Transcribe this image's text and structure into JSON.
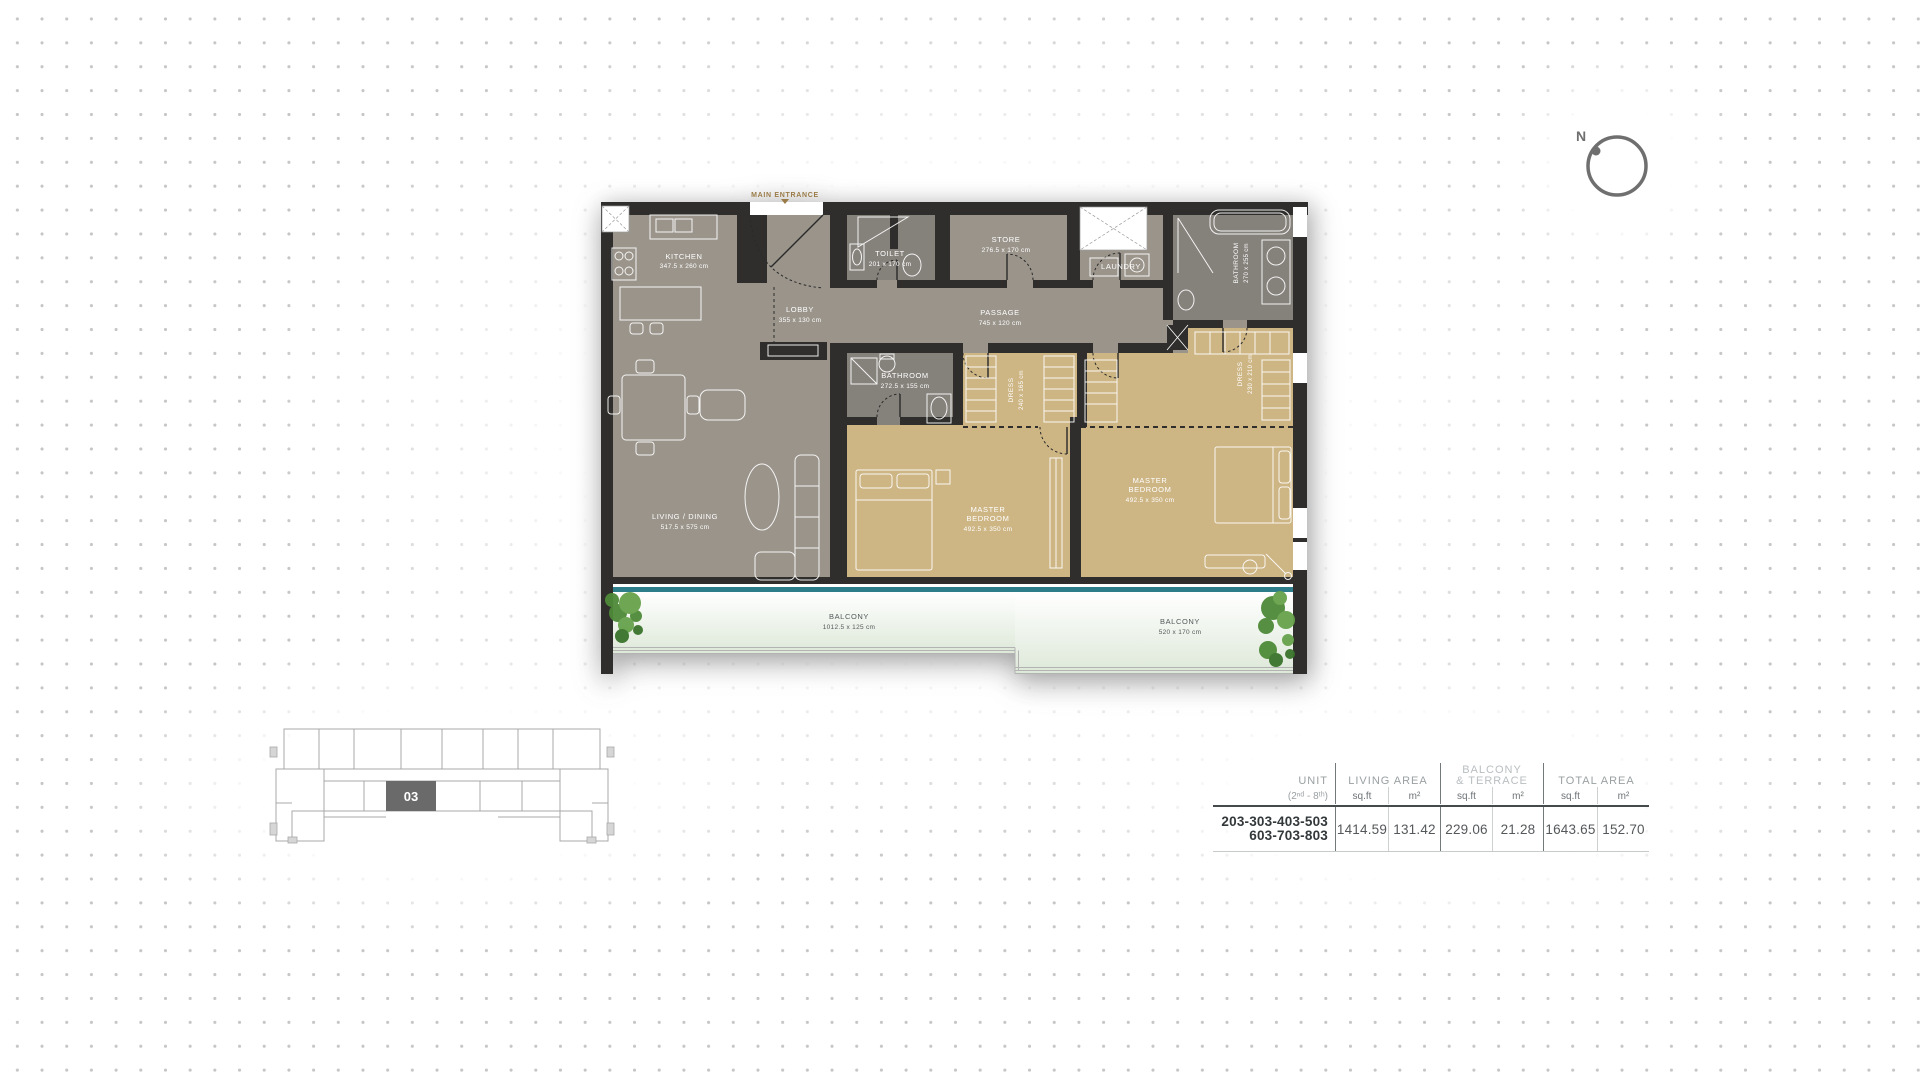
{
  "compass": {
    "label": "N"
  },
  "plan": {
    "entrance": {
      "label": "MAIN ENTRANCE"
    },
    "rooms": {
      "kitchen": {
        "name": "KITCHEN",
        "dims": "347.5 x 260 cm"
      },
      "toilet": {
        "name": "TOILET",
        "dims": "201 x 170 cm"
      },
      "store": {
        "name": "STORE",
        "dims": "276.5 x 170 cm"
      },
      "laundry": {
        "name": "LAUNDRY"
      },
      "bathroom_top_right": {
        "name": "BATHROOM",
        "dims": "270 x 255 cm"
      },
      "dress_right": {
        "name": "DRESS",
        "dims": "230 x 210 cm"
      },
      "lobby": {
        "name": "LOBBY",
        "dims": "355 x 130 cm"
      },
      "passage": {
        "name": "PASSAGE",
        "dims": "745 x 120 cm"
      },
      "bathroom_middle": {
        "name": "BATHROOM",
        "dims": "272.5 x 155 cm"
      },
      "dress_middle": {
        "name": "DRESS",
        "dims": "240 x 165 cm"
      },
      "living_dining": {
        "name": "LIVING / DINING",
        "dims": "517.5 x 575 cm"
      },
      "master_bedroom_1": {
        "line1": "MASTER",
        "line2": "BEDROOM",
        "dims": "492.5 x 350 cm"
      },
      "master_bedroom_2": {
        "line1": "MASTER",
        "line2": "BEDROOM",
        "dims": "492.5 x 350 cm"
      },
      "balcony_main": {
        "name": "BALCONY",
        "dims": "1012.5 x 125 cm"
      },
      "balcony_right": {
        "name": "BALCONY",
        "dims": "520 x 170 cm"
      }
    },
    "colors": {
      "wall": "#2f2e2c",
      "floor_gray": "#9a948b",
      "floor_bathroom": "#85817b",
      "floor_bedroom": "#cdb584",
      "glass": "#2e7d8a",
      "entrance_accent": "#9a7b47",
      "plant_green": "#4e8a38"
    }
  },
  "key_plan": {
    "highlighted_unit": "03",
    "unit_fill": "#6a6a6a"
  },
  "area_table": {
    "header": {
      "unit_title": "UNIT",
      "unit_subtitle": "(2ⁿᵈ - 8ᵗʰ)",
      "living_area": "LIVING AREA",
      "balcony_line1": "BALCONY",
      "balcony_line2": "& TERRACE",
      "total_area": "TOTAL AREA",
      "sqft": "sq.ft",
      "m2": "m²"
    },
    "row": {
      "units_line1": "203-303-403-503",
      "units_line2": "603-703-803",
      "living_sqft": "1414.59",
      "living_m2": "131.42",
      "balcony_sqft": "229.06",
      "balcony_m2": "21.28",
      "total_sqft": "1643.65",
      "total_m2": "152.70"
    }
  }
}
